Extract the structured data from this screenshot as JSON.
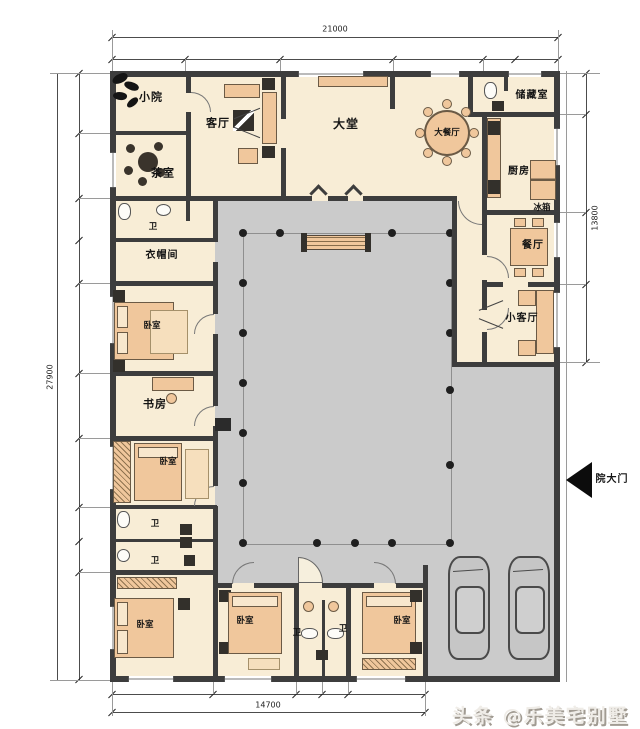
{
  "dims": {
    "top": "21000",
    "left": "27900",
    "right": "13800",
    "bottom": "14700"
  },
  "rooms": {
    "small_yard": "小院",
    "tea_room": "茶室",
    "living_room": "客厅",
    "great_hall": "大堂",
    "big_dining": "大餐厅",
    "storage": "储藏室",
    "kitchen": "厨房",
    "fridge": "冰箱",
    "dining": "餐厅",
    "small_living": "小客厅",
    "bath": "卫",
    "cloak_room": "衣帽间",
    "bedroom": "卧室",
    "study": "书房",
    "gate": "院大门"
  },
  "watermark": "头条 @乐美宅别墅",
  "colors": {
    "wall": "#3d3d3d",
    "floor": "#f8edd6",
    "courtyard": "#cbcbcb",
    "furniture": "#f0c79c",
    "dimension_line": "#4c4c4c",
    "watermark_text": "#efece7",
    "watermark_shadow": "#a19b92"
  }
}
